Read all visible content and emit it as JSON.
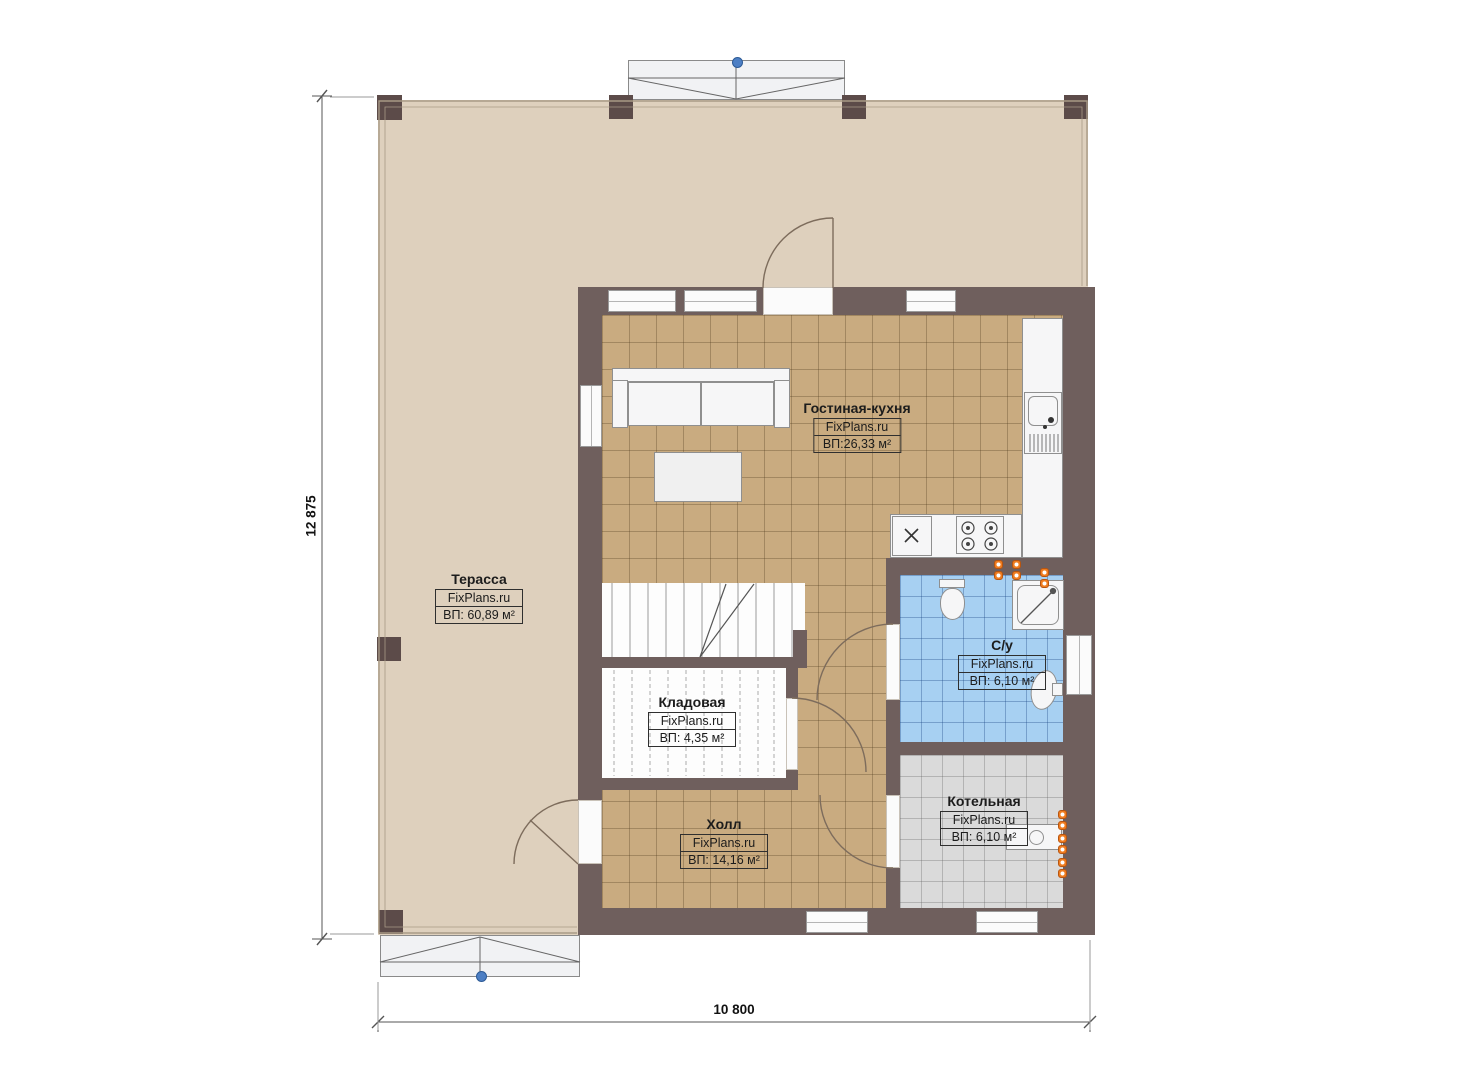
{
  "rooms": [
    {
      "id": "terrace",
      "name": "Терасса",
      "watermark": "FixPlans.ru",
      "area": "ВП: 60,89 м²"
    },
    {
      "id": "living-kitchen",
      "name": "Гостиная-кухня",
      "watermark": "FixPlans.ru",
      "area": "ВП:26,33 м²"
    },
    {
      "id": "storage",
      "name": "Кладовая",
      "watermark": "FixPlans.ru",
      "area": "ВП: 4,35 м²"
    },
    {
      "id": "hall",
      "name": "Холл",
      "watermark": "FixPlans.ru",
      "area": "ВП: 14,16 м²"
    },
    {
      "id": "bathroom",
      "name": "С/у",
      "watermark": "FixPlans.ru",
      "area": "ВП: 6,10 м²"
    },
    {
      "id": "boiler",
      "name": "Котельная",
      "watermark": "FixPlans.ru",
      "area": "ВП: 6,10 м²"
    }
  ],
  "dimensions": {
    "vertical": "12 875",
    "horizontal": "10 800"
  },
  "colors": {
    "wall": "#6f5f5d",
    "column": "#5c4b49",
    "terrace": "#ded0bd",
    "terrace-line": "#a89a86",
    "tile-tan": "#c9ab80",
    "tile-blue": "#a7d0f2",
    "tile-gray": "#dadada",
    "fixture": "#f6f6f7",
    "fixture-line": "#8f8f8f",
    "outlet": "#f07d20",
    "marker": "#4d7fc4",
    "dim-line": "#555555",
    "label-text": "#1c1c1c"
  }
}
